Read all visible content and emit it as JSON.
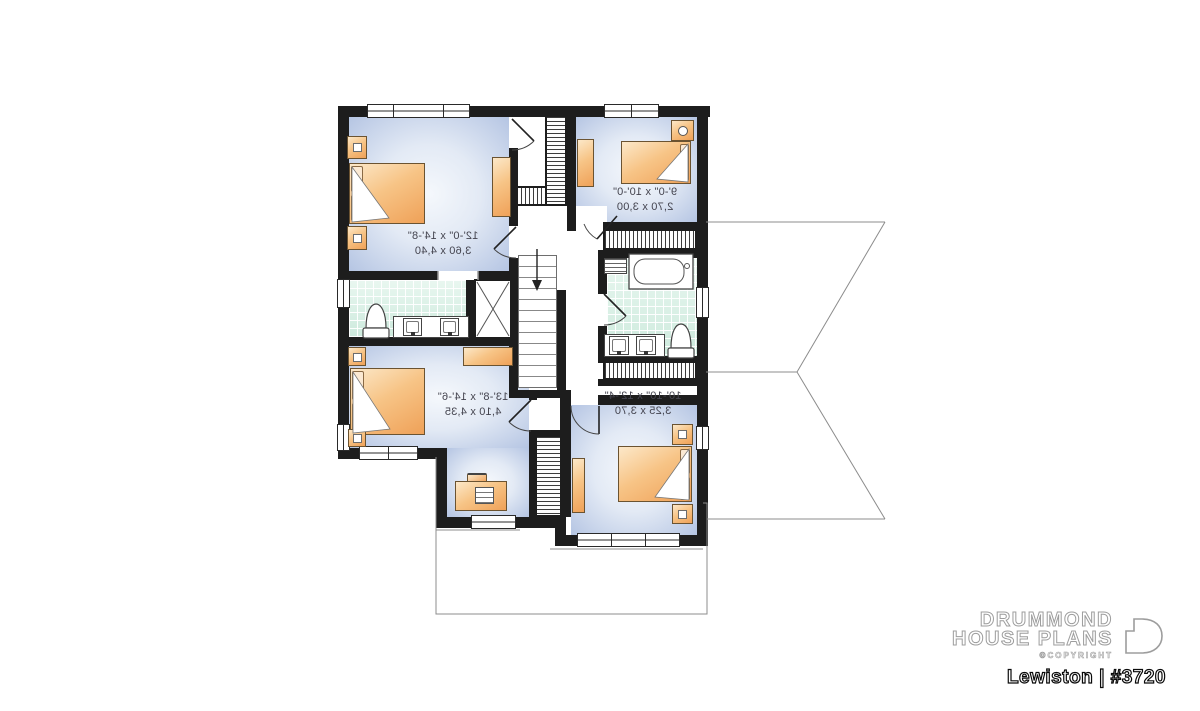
{
  "plan": {
    "rooms": [
      {
        "name": "bedroom-top-left",
        "dim_imperial": "12'-0\" x 14'-8\"",
        "dim_metric": "3,60 x 4,40"
      },
      {
        "name": "bedroom-top-right",
        "dim_imperial": "9'-0\" x 10'-0\"",
        "dim_metric": "2,70 x 3,00"
      },
      {
        "name": "bedroom-bottom-left",
        "dim_imperial": "13'-8\" x 14'-6\"",
        "dim_metric": "4,10 x 4,35"
      },
      {
        "name": "bedroom-bottom-right",
        "dim_imperial": "10'-10\" x 12'-4\"",
        "dim_metric": "3,25 x 3,70"
      }
    ]
  },
  "footer": {
    "brand_line1": "DRUMMOND",
    "brand_line2": "HOUSE PLANS",
    "copyright": "©COPYRIGHT",
    "plan_name": "Lewiston | #3720"
  },
  "colors": {
    "wall": "#1d1d1d",
    "floor_light": "#f5f8fc",
    "floor_dark": "#b5c5e3",
    "bath_tile": "#d9efe6",
    "furniture": "#f0a45c",
    "roofline": "#8c8c8c"
  }
}
